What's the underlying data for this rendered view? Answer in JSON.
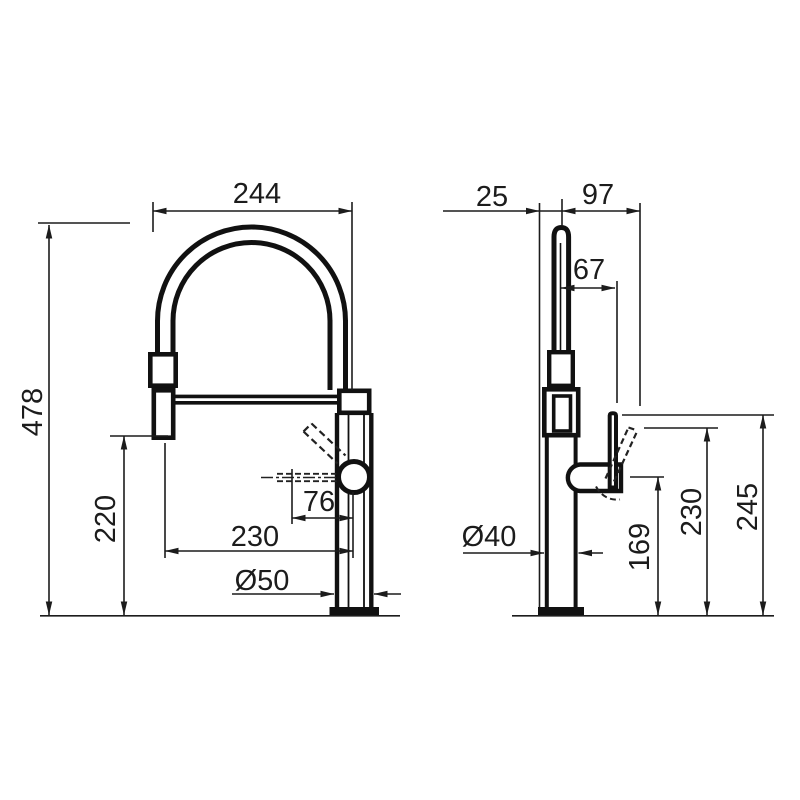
{
  "page": {
    "background": "#ffffff",
    "line_color": "#1a1a1a",
    "kind": "faucet dimensional technical drawing"
  },
  "front_view": {
    "name": "front-view",
    "dims": {
      "spout_width": "244",
      "overall_height": "478",
      "outlet_height": "220",
      "outlet_reach": "230",
      "nozzle_offset": "76",
      "base_diameter": "Ø50"
    }
  },
  "side_view": {
    "name": "side-view",
    "dims": {
      "spout_offset": "25",
      "lever_reach": "97",
      "lever_offset": "67",
      "body_diameter": "Ø40",
      "outlet_height": "169",
      "lever_tilted_height": "230",
      "lever_height": "245"
    }
  }
}
